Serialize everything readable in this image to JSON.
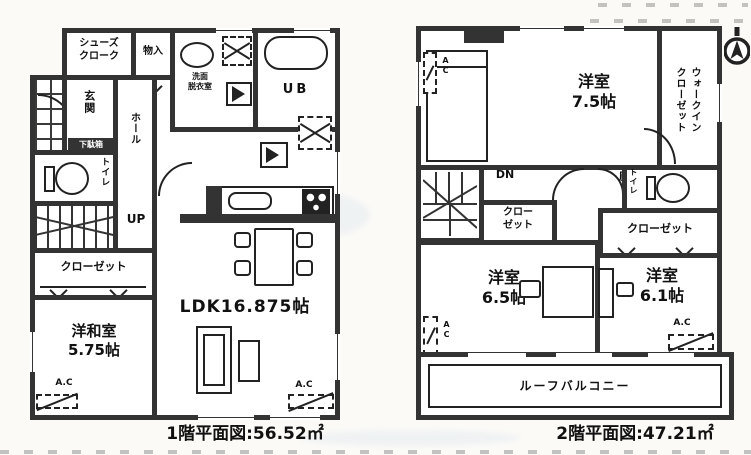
{
  "colors": {
    "wall": "#333333",
    "line": "#222222",
    "bg": "#fbfaf7",
    "tint": "#c9dbec"
  },
  "floor1": {
    "caption": "1階平面図:56.52㎡",
    "labels": {
      "shoes_closet": "シューズ\nクローク",
      "storage": "物入",
      "washroom": "洗面\n脱衣室",
      "unit_bath": "UB",
      "entrance": "玄関",
      "shoe_box": "下駄箱",
      "hall": "ホール",
      "toilet": "トイレ",
      "stairs_up": "UP",
      "closet": "クローゼット",
      "japanese_room": "洋和室\n5.75帖",
      "ldk": "LDK16.875帖",
      "ac": "A.C"
    }
  },
  "floor2": {
    "caption": "2階平面図:47.21㎡",
    "labels": {
      "bedroom_75": "洋室\n7.5帖",
      "walk_in_closet": "ウォークイン\nクローゼット",
      "stairs_down": "DN",
      "hallway": "廊下",
      "closet_small": "クロー\nゼット",
      "toilet": "トイレ",
      "closet_wide": "クローゼット",
      "bedroom_65": "洋室\n6.5帖",
      "bedroom_61": "洋室\n6.1帖",
      "roof_balcony": "ルーフバルコニー",
      "ac_vertical": "AC",
      "ac": "A.C"
    }
  }
}
